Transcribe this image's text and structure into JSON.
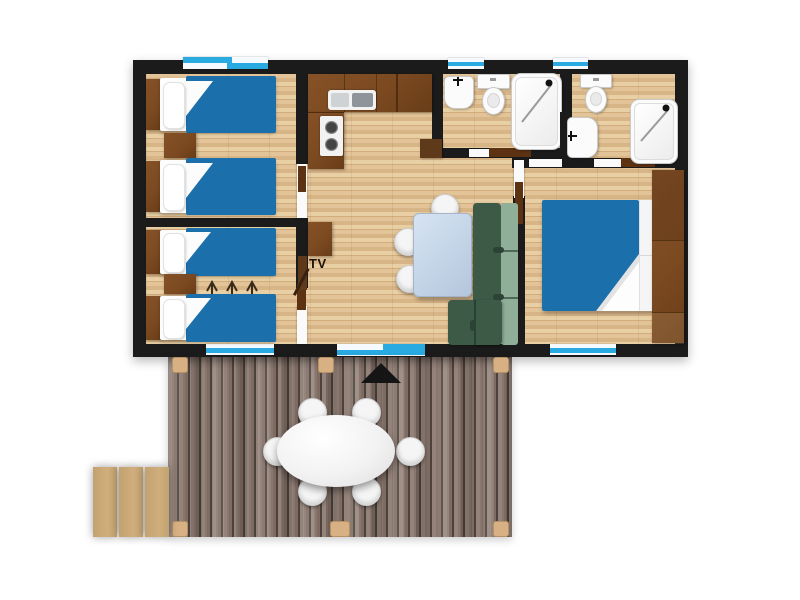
{
  "labels": {
    "tv_label": "TV"
  },
  "icons": {
    "entrance_marker": "black-triangle-up",
    "bed_join_arrows": "three-up-arrows",
    "shower_head": "black-dot-with-diagonal",
    "faucet": "black-tee",
    "stove_burners": "two-dark-circles"
  },
  "colors": {
    "wall": "#1b1b1b",
    "floor_light": "#e3c498",
    "floor_dark": "#d1ac7c",
    "bed_blue": "#1b6fab",
    "window_cyan": "#29abe2",
    "brown": "#7c4a21",
    "brown_dark": "#5e3a1b",
    "door": "#5c3212",
    "sofa_dark": "#3d5a47",
    "sofa_light": "#90af99",
    "table_blue": "#c7d7ea",
    "deck_light": "#94837b",
    "deck_mid": "#7e6c63",
    "deck_gap": "#4d423b",
    "post_tan": "#d7b183",
    "step_tan": "#cfae7c",
    "fixture_border": "#c9c9c9",
    "text": "#1a1208"
  }
}
